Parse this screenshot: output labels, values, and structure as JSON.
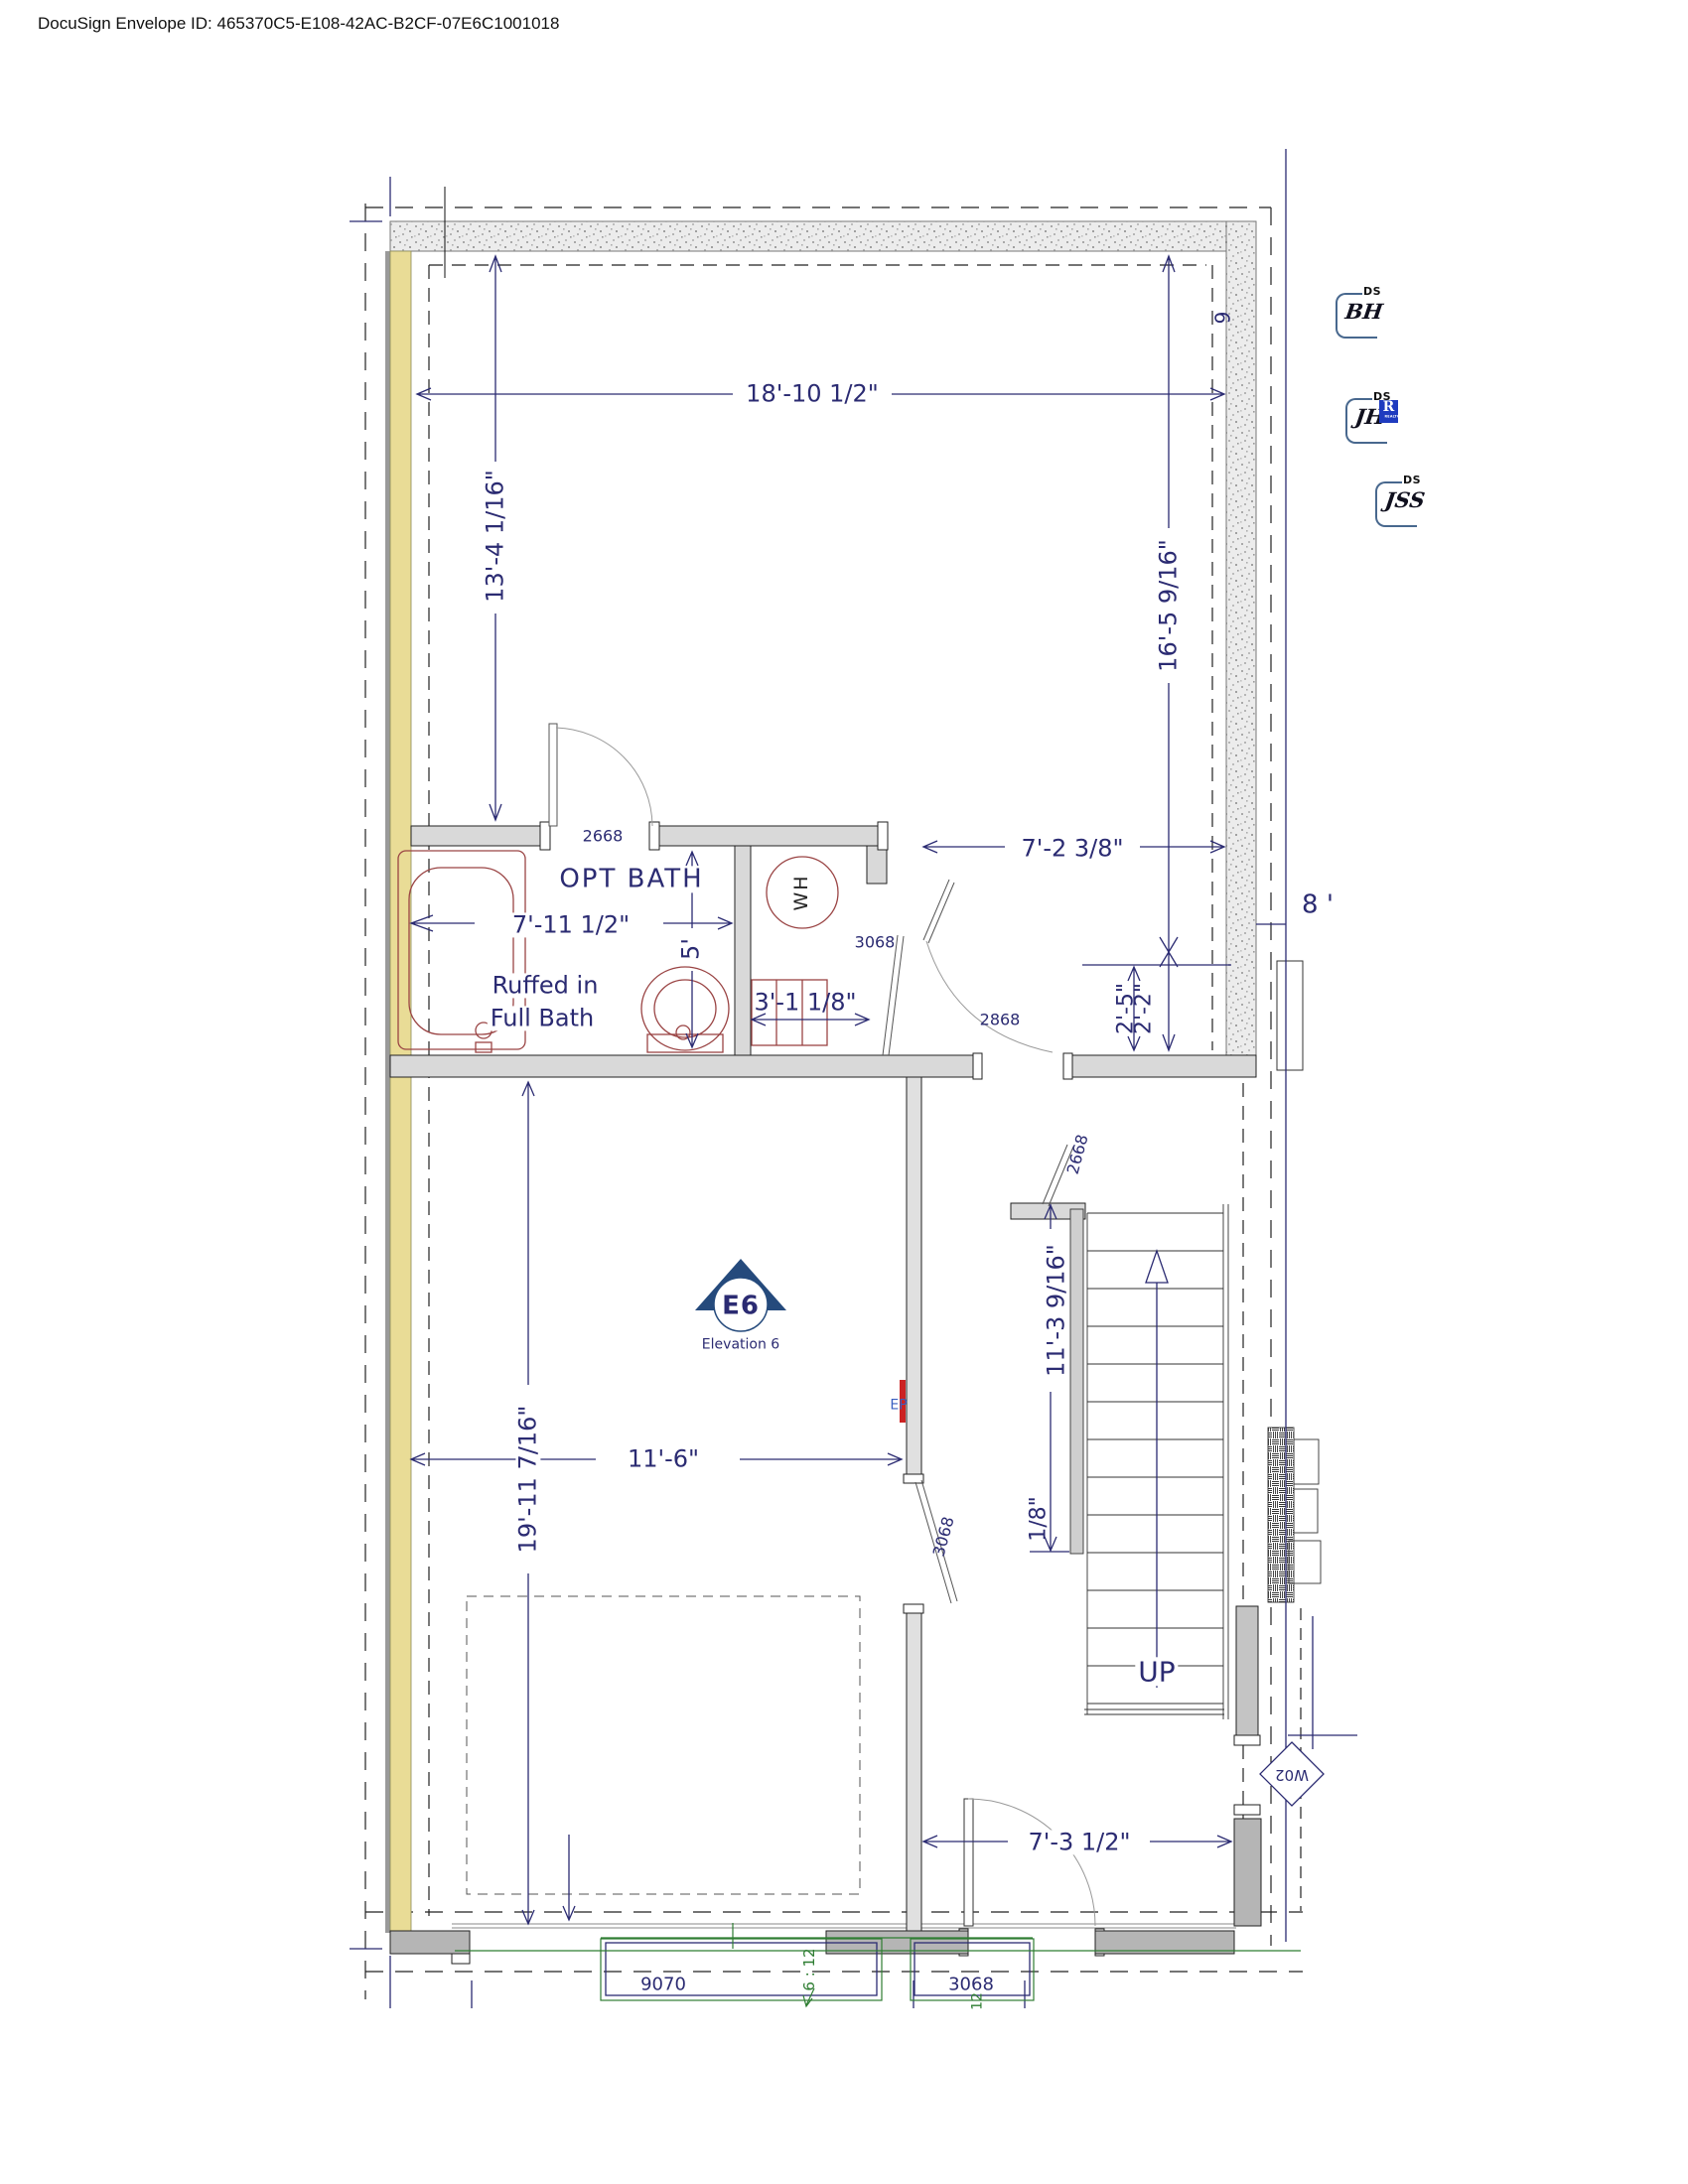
{
  "document": {
    "header": "DocuSign Envelope ID: 465370C5-E108-42AC-B2CF-07E6C1001018"
  },
  "stamps": {
    "ds_label": "DS",
    "initials": [
      "BH",
      "JH",
      "JSS"
    ],
    "realtor_r": "R",
    "realtor_text": "REALTOR"
  },
  "plan": {
    "rooms": {
      "opt_bath": "OPT BATH",
      "ruffed_in_line1": "Ruffed in",
      "ruffed_in_line2": "Full Bath",
      "water_heater": "WH",
      "stairs_up": "UP"
    },
    "dimensions": {
      "top_width": "18'-10 1/2\"",
      "left_height": "13'-4 1/16\"",
      "right_height": "16'-5 9/16\"",
      "hall_width": "7'-2 3/8\"",
      "bath_width": "7'-11 1/2\"",
      "bath_depth": "5'",
      "wh_width": "3'-1 1/8\"",
      "offset_2_5": "2'-5\"",
      "offset_2_2": "2'-2\"",
      "stair_run": "11'-3 9/16\"",
      "stair_gap": "1/8\"",
      "room_width": "11'-6\"",
      "room_height": "19'-11 7/16\"",
      "entry_width": "7'-3 1/2\""
    },
    "doors": {
      "bath_door": "2668",
      "wh_door": "3068",
      "hall_door": "2868",
      "stair_door": "2668",
      "mid_door": "3068",
      "garage_door": "9070",
      "bottom_door": "3068"
    },
    "markers": {
      "e6": "E6",
      "e6_caption": "Elevation 6",
      "window": "W02",
      "electrical_panel": "EP",
      "num_9": "9",
      "num_8": "8 '",
      "roof_pitch": "6 : 12",
      "roof_12": "12"
    },
    "colors": {
      "dimension_navy": "#2b2b72",
      "roof_green": "#2e7d32",
      "panel_red": "#cc2222",
      "fixture_maroon": "#9a4444",
      "wall_yellow": "#e9dc96",
      "stamp_blue": "#48688e",
      "realtor_blue": "#1f3bbf"
    }
  }
}
